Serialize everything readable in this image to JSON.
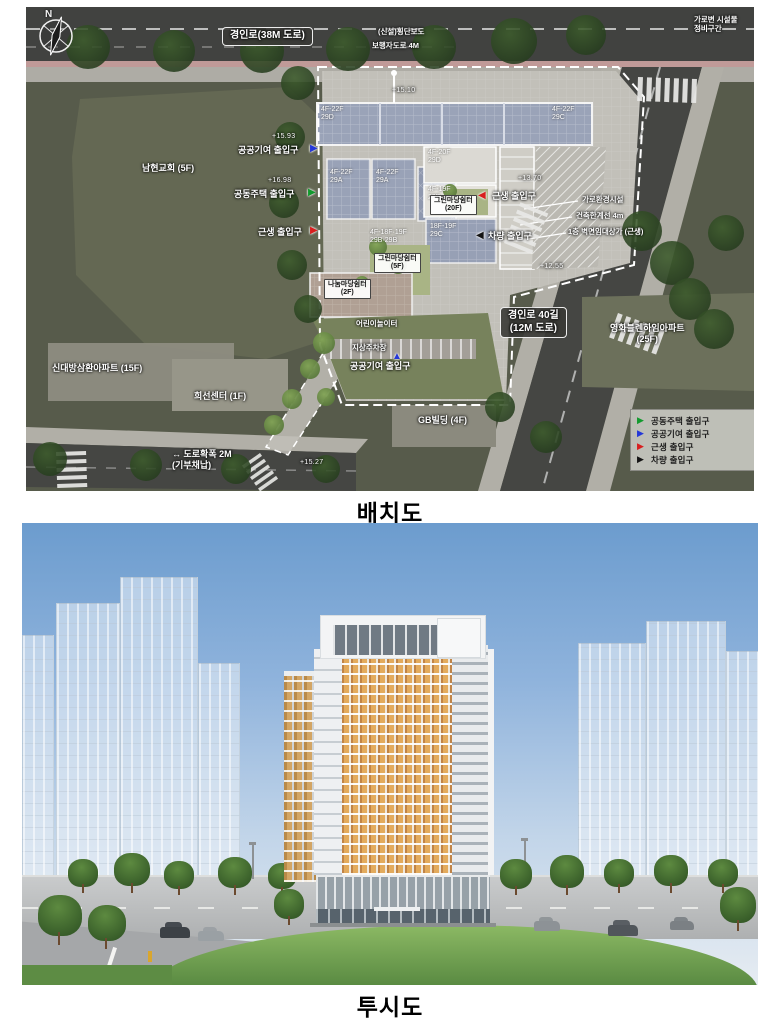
{
  "captions": {
    "site_plan": "배치도",
    "perspective": "투시도"
  },
  "site_plan": {
    "north_label": "N",
    "legend": {
      "items": [
        {
          "color": "#129a2e",
          "label": "공동주택 출입구"
        },
        {
          "color": "#2438d8",
          "label": "공공기여 출입구"
        },
        {
          "color": "#d81f1f",
          "label": "근생 출입구"
        },
        {
          "color": "#141414",
          "label": "차량 출입구"
        }
      ]
    },
    "road_labels": {
      "top": "경인로(38M 도로)",
      "right": "경인로 40길 (12M 도로)"
    },
    "spot_levels": [
      "+15.10",
      "+15.93",
      "+16.98",
      "+13.70",
      "+12.55",
      "+15.27"
    ],
    "annotations": [
      {
        "t": "경인로(38M 도로)",
        "x": 196,
        "y": 20,
        "c": "roadbox"
      },
      {
        "t": "경인로 40길\n(12M 도로)",
        "x": 474,
        "y": 300,
        "c": "roadbox"
      },
      {
        "t": "+15.10",
        "x": 366,
        "y": 80,
        "c": "level"
      },
      {
        "t": "+15.93",
        "x": 246,
        "y": 126,
        "c": "level"
      },
      {
        "t": "+16.98",
        "x": 242,
        "y": 170,
        "c": "level"
      },
      {
        "t": "+13.70",
        "x": 492,
        "y": 168,
        "c": "level"
      },
      {
        "t": "+12.55",
        "x": 514,
        "y": 256,
        "c": "level"
      },
      {
        "t": "+15.27",
        "x": 274,
        "y": 452,
        "c": "level"
      },
      {
        "t": "공공기여 출입구",
        "x": 212,
        "y": 138,
        "c": "entry"
      },
      {
        "t": "공동주택 출입구",
        "x": 208,
        "y": 182,
        "c": "entry"
      },
      {
        "t": "근생 출입구",
        "x": 232,
        "y": 220,
        "c": "entry"
      },
      {
        "t": "근생 출입구",
        "x": 466,
        "y": 184,
        "c": "entry"
      },
      {
        "t": "차량 출입구",
        "x": 462,
        "y": 224,
        "c": "entry"
      },
      {
        "t": "공공기여 출입구",
        "x": 324,
        "y": 354,
        "c": "entry"
      },
      {
        "t": "↔ 도로확폭 2M\n(기부채납)",
        "x": 146,
        "y": 442,
        "c": "entry"
      },
      {
        "t": "▶",
        "x": 284,
        "y": 136,
        "c": "marker",
        "col": "#2438d8"
      },
      {
        "t": "▶",
        "x": 282,
        "y": 180,
        "c": "marker",
        "col": "#129a2e"
      },
      {
        "t": "▶",
        "x": 284,
        "y": 218,
        "c": "marker",
        "col": "#d81f1f"
      },
      {
        "t": "◀",
        "x": 452,
        "y": 183,
        "c": "marker",
        "col": "#d81f1f"
      },
      {
        "t": "◀",
        "x": 450,
        "y": 223,
        "c": "marker",
        "col": "#141414"
      },
      {
        "t": "▲",
        "x": 366,
        "y": 344,
        "c": "marker",
        "col": "#2438d8"
      },
      {
        "t": "남현교회 (5F)",
        "x": 116,
        "y": 156,
        "c": "parcel"
      },
      {
        "t": "신대방삼환아파트 (15F)",
        "x": 26,
        "y": 356,
        "c": "parcel"
      },
      {
        "t": "희선센터 (1F)",
        "x": 168,
        "y": 384,
        "c": "parcel"
      },
      {
        "t": "GB빌딩 (4F)",
        "x": 392,
        "y": 408,
        "c": "parcel"
      },
      {
        "t": "영화블렌하임아파트\n(25F)",
        "x": 584,
        "y": 316,
        "c": "parcel"
      },
      {
        "t": "(신설)횡단보도",
        "x": 352,
        "y": 20,
        "c": "note"
      },
      {
        "t": "보행자도로 4M",
        "x": 346,
        "y": 34,
        "c": "note"
      },
      {
        "t": "가로변 시설물\n정비구간",
        "x": 668,
        "y": 8,
        "c": "note"
      },
      {
        "t": "가로환경시설",
        "x": 556,
        "y": 188,
        "c": "note"
      },
      {
        "t": "건축한계선 4m",
        "x": 550,
        "y": 204,
        "c": "note"
      },
      {
        "t": "1층 벽면임대상가 (근생)",
        "x": 542,
        "y": 220,
        "c": "note"
      },
      {
        "t": "어린이놀이터",
        "x": 330,
        "y": 312,
        "c": "note"
      },
      {
        "t": "지상주차장",
        "x": 326,
        "y": 336,
        "c": "note"
      },
      {
        "t": "4F-22F\n29D",
        "x": 295,
        "y": 99,
        "c": "unit"
      },
      {
        "t": "4F-22F\n29C",
        "x": 526,
        "y": 99,
        "c": "unit"
      },
      {
        "t": "4F-22F\n29A",
        "x": 304,
        "y": 162,
        "c": "unit"
      },
      {
        "t": "4F-22F\n29A",
        "x": 350,
        "y": 162,
        "c": "unit"
      },
      {
        "t": "4F-20F\n29D",
        "x": 402,
        "y": 142,
        "c": "unit"
      },
      {
        "t": "4F-19F\n29B",
        "x": 402,
        "y": 179,
        "c": "unit"
      },
      {
        "t": "18F-19F\n29C",
        "x": 404,
        "y": 216,
        "c": "unit"
      },
      {
        "t": "4F-18F·19F\n29B·29B",
        "x": 344,
        "y": 222,
        "c": "unit"
      },
      {
        "t": "그린마당쉼터\n(20F)",
        "x": 404,
        "y": 188,
        "c": "tag"
      },
      {
        "t": "그린마당쉼터\n(5F)",
        "x": 348,
        "y": 246,
        "c": "tag"
      },
      {
        "t": "나눔마당쉼터\n(2F)",
        "x": 298,
        "y": 272,
        "c": "tag"
      }
    ],
    "colors": {
      "road": "#414240",
      "parcel": "#575b4b",
      "site_deck": "#c2c0b9",
      "roof_grid": "#9aa3b8",
      "court_green": "#a9b485"
    }
  },
  "perspective": {
    "colors": {
      "sky_top": "#6c9cce",
      "sky_bottom": "#e6ecf2",
      "facade_orange": "#d99a4e",
      "facade_white": "#eef0f2",
      "podium": "#97a1a8",
      "lawn": "#6ca34f"
    }
  }
}
